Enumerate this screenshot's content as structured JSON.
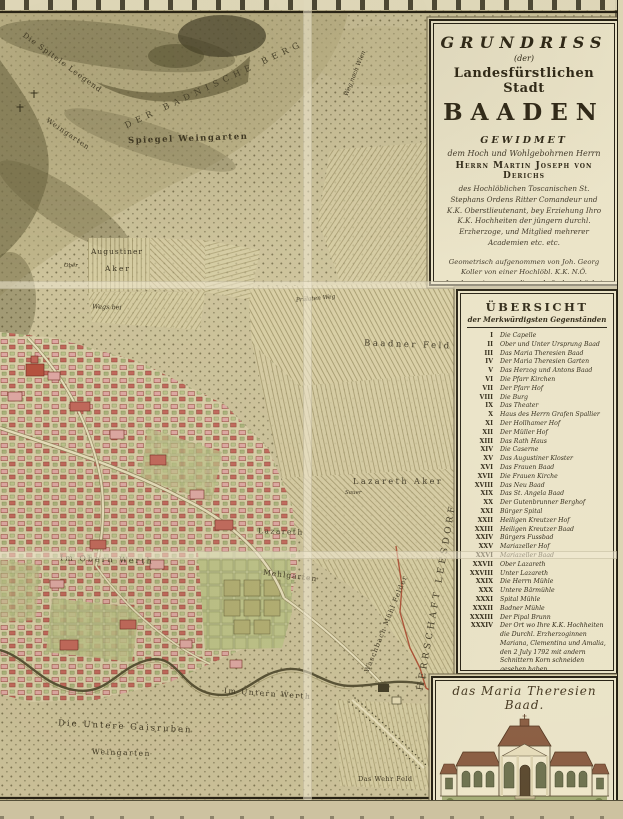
{
  "map": {
    "labels": [
      {
        "id": "spitele-leegend",
        "text": "Die Spitele Leegend"
      },
      {
        "id": "badnische-berg",
        "text": "DER BADNISCHE BERG"
      },
      {
        "id": "spiegel-weingarten",
        "text": "Spiegel Weingarten"
      },
      {
        "id": "weingarten-hang",
        "text": "Weingarten"
      },
      {
        "id": "augustiner",
        "text": "Augustiner"
      },
      {
        "id": "aker",
        "text": "Aker"
      },
      {
        "id": "ober",
        "text": "Ober"
      },
      {
        "id": "wegs-bei",
        "text": "Wegs bei"
      },
      {
        "id": "praelaten-weg",
        "text": "Prälaten Weg"
      },
      {
        "id": "baadner-feld",
        "text": "Baadner Feld"
      },
      {
        "id": "weg-nach-wien",
        "text": "Weg nach Wien"
      },
      {
        "id": "lazareth-aker",
        "text": "Lazareth Aker"
      },
      {
        "id": "sauer",
        "text": "Sauer"
      },
      {
        "id": "lazareth",
        "text": "Lazareth"
      },
      {
        "id": "mehlgarten",
        "text": "Mehlgarten"
      },
      {
        "id": "im-obern-werth",
        "text": "Im Obern Werth"
      },
      {
        "id": "waschbach-muehl-felder",
        "text": "Waschbach Mühl Felder"
      },
      {
        "id": "herrschaft-leesdorf",
        "text": "HERRSCHAFT LEESDORF"
      },
      {
        "id": "im-untern-werth",
        "text": "Im Untern Werth"
      },
      {
        "id": "die-untere-gaisruben",
        "text": "Die Untere Gaisruben"
      },
      {
        "id": "weingarten-unten",
        "text": "Weingarten"
      },
      {
        "id": "das-wehr-feld",
        "text": "Das Wehr Feld"
      }
    ]
  },
  "cartouche": {
    "title1": "GRUNDRISS",
    "title2": "(der)",
    "title3": "Landesfürstlichen Stadt",
    "title4": "BAADEN",
    "gewidmet": "GEWIDMET",
    "sub": "dem Hoch und Wohlgebohrnen Herrn",
    "dedicatee": "Herrn Martin Joseph von Derichs",
    "body": "des Hochlöblichen Toscanischen St. Stephans Ordens Ritter Comandeur und K.K. Oberstlieutenant, bey Erziehung Ihro K.K. Hochheiten der jüngern durchl. Erzherzoge, und Mitglied mehrerer Academien etc. etc.",
    "surveyor": "Geometrisch aufgenommen von Joh. Georg Koller von einer Hochlöbl. K.K. N.Ö. Landesregierung zu dieser Aufnahme höchst verordneten Ingenieur",
    "engraver": "Gestochen von Hieronymus Benedicti in Wien 1788."
  },
  "legend": {
    "title": "ÜBERSICHT",
    "subtitle": "der Merkwürdigsten Gegenständen",
    "items": [
      {
        "num": "I",
        "label": "Die Capelle"
      },
      {
        "num": "II",
        "label": "Ober und Unter Ursprung Baad"
      },
      {
        "num": "III",
        "label": "Das Maria Theresien Baad"
      },
      {
        "num": "IV",
        "label": "Der Maria Theresien Garten"
      },
      {
        "num": "V",
        "label": "Das Herzog und Antons Baad"
      },
      {
        "num": "VI",
        "label": "Die Pfarr Kirchen"
      },
      {
        "num": "VII",
        "label": "Der Pfarr Hof"
      },
      {
        "num": "VIII",
        "label": "Die Burg"
      },
      {
        "num": "IX",
        "label": "Das Theater"
      },
      {
        "num": "X",
        "label": "Haus des Herrn Grafen Spallier"
      },
      {
        "num": "XI",
        "label": "Der Hollhamer Hof"
      },
      {
        "num": "XII",
        "label": "Der Müller Hof"
      },
      {
        "num": "XIII",
        "label": "Das Rath Haus"
      },
      {
        "num": "XIV",
        "label": "Die Caserne"
      },
      {
        "num": "XV",
        "label": "Das Augustiner Kloster"
      },
      {
        "num": "XVI",
        "label": "Das Frauen Baad"
      },
      {
        "num": "XVII",
        "label": "Die Frauen Kirche"
      },
      {
        "num": "XVIII",
        "label": "Das Neu Baad"
      },
      {
        "num": "XIX",
        "label": "Das St. Angela Baad"
      },
      {
        "num": "XX",
        "label": "Der Gutenbrunner Berghof"
      },
      {
        "num": "XXI",
        "label": "Bürger Spital"
      },
      {
        "num": "XXII",
        "label": "Heiligen Kreutzer Hof"
      },
      {
        "num": "XXIII",
        "label": "Heiligen Kreutzer Baad"
      },
      {
        "num": "XXIV",
        "label": "Bürgers Fussbad"
      },
      {
        "num": "XXV",
        "label": "Mariazeller Hof"
      },
      {
        "num": "XXVI",
        "label": "Mariazeller Baad"
      },
      {
        "num": "XXVII",
        "label": "Ober Lazareth"
      },
      {
        "num": "XXVIII",
        "label": "Unter Lazareth"
      },
      {
        "num": "XXIX",
        "label": "Die Herrn Mühle"
      },
      {
        "num": "XXX",
        "label": "Untere Bärmühle"
      },
      {
        "num": "XXXI",
        "label": "Spital Mühle"
      },
      {
        "num": "XXXII",
        "label": "Badner Mühle"
      },
      {
        "num": "XXXIII",
        "label": "Der Pipal Brunn"
      },
      {
        "num": "XXXIV",
        "label": "Der Ort wo Ihre K.K. Hochheiten die Durchl. Erzherzoginnen Mariana, Clementina und Amalia, den 2 July 1792 mit andern Schnittern Korn schneiden gesehen haben."
      }
    ]
  },
  "picture": {
    "caption": "das Maria Theresien Baad."
  },
  "colors": {
    "paper": "#cdc39b",
    "panel_cream": "#eae3c7",
    "ink": "#241f12",
    "hill_shade": "#55512f",
    "field_line": "#a2976b",
    "town_pink": "#dfa8a4",
    "town_red": "#c2675b",
    "garden_green": "#b2af72",
    "river": "#4e492d",
    "boundary_red": "#a8442a"
  }
}
